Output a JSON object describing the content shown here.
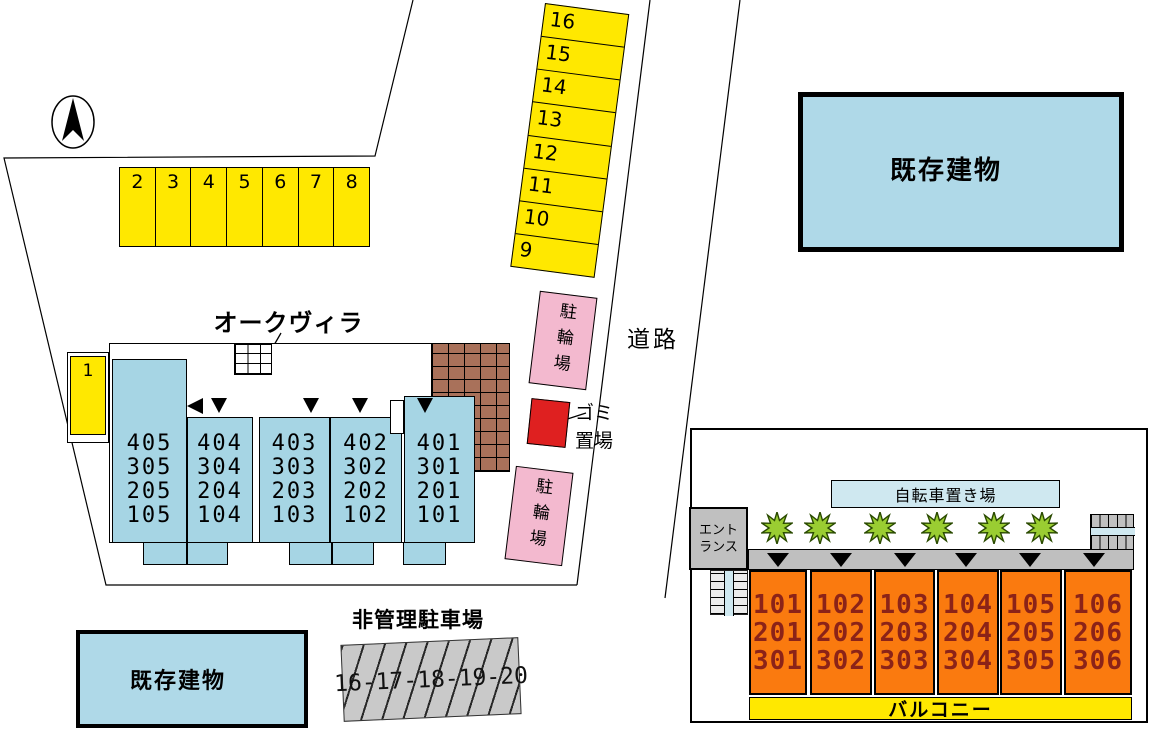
{
  "site_plan": {
    "title": "オークヴィラ",
    "road_label": "道路",
    "existing_building_top": "既存建物",
    "existing_building_bottom": "既存建物",
    "unmanaged_parking_label": "非管理駐車場",
    "unmanaged_parking_numbers": "16-17-18-19-20",
    "parking_space_single": "1",
    "parking_row": [
      "2",
      "3",
      "4",
      "5",
      "6",
      "7",
      "8"
    ],
    "parking_column": [
      "16",
      "15",
      "14",
      "13",
      "12",
      "11",
      "10",
      "9"
    ],
    "bicycle_parking_top": "駐輪場",
    "bicycle_parking_bottom": "駐輪場",
    "garbage_line1": "ゴミ",
    "garbage_line2": "置場",
    "residence_columns": [
      {
        "rooms": [
          "405",
          "305",
          "205",
          "105"
        ]
      },
      {
        "rooms": [
          "404",
          "304",
          "204",
          "104"
        ]
      },
      {
        "rooms": [
          "403",
          "303",
          "203",
          "103"
        ]
      },
      {
        "rooms": [
          "402",
          "302",
          "202",
          "102"
        ]
      },
      {
        "rooms": [
          "401",
          "301",
          "201",
          "101"
        ]
      }
    ]
  },
  "floor_plan": {
    "bicycle_area_label": "自転車置き場",
    "entrance_line1": "エント",
    "entrance_line2": "ランス",
    "balcony_label": "バルコニー",
    "unit_columns": [
      {
        "rooms": [
          "101",
          "201",
          "301"
        ]
      },
      {
        "rooms": [
          "102",
          "202",
          "302"
        ]
      },
      {
        "rooms": [
          "103",
          "203",
          "303"
        ]
      },
      {
        "rooms": [
          "104",
          "204",
          "304"
        ]
      },
      {
        "rooms": [
          "105",
          "205",
          "305"
        ]
      },
      {
        "rooms": [
          "106",
          "206",
          "306"
        ]
      }
    ]
  },
  "colors": {
    "parking_yellow": "#FFE800",
    "residence_blue": "#A6D5E4",
    "existing_building_blue": "#AFD9E8",
    "bicycle_pink": "#F3B9CF",
    "garbage_red": "#DF2020",
    "brick_brown": "#A9715A",
    "unit_orange": "#FA7A0F",
    "unit_number_maroon": "#8B2318",
    "walkway_gray": "#BFBFBF",
    "bicycle_bar_blue": "#CFE8F0",
    "bush_green": "#9ACD32",
    "hatch_gray": "#C9C9C9"
  }
}
